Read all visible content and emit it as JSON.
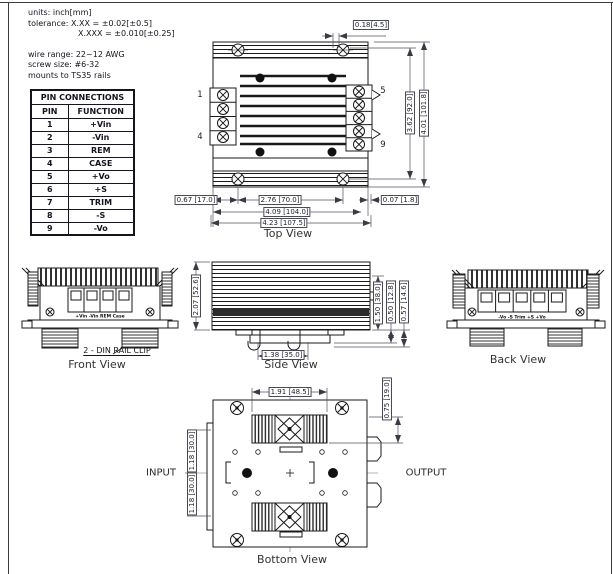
{
  "notes": {
    "units": "units: inch[mm]",
    "tol1": "tolerance: X.XX = ±0.02[±0.5]",
    "tol2": "X.XXX = ±0.010[±0.25]",
    "wire": "wire range: 22~12 AWG",
    "screw": "screw size: #6-32",
    "mount": "mounts to TS35 rails"
  },
  "pin_table": {
    "title": "PIN CONNECTIONS",
    "headers": {
      "pin": "PIN",
      "function": "FUNCTION"
    },
    "rows": [
      {
        "pin": "1",
        "fn": "+Vin"
      },
      {
        "pin": "2",
        "fn": "-Vin"
      },
      {
        "pin": "3",
        "fn": "REM"
      },
      {
        "pin": "4",
        "fn": "CASE"
      },
      {
        "pin": "5",
        "fn": "+Vo"
      },
      {
        "pin": "6",
        "fn": "+S"
      },
      {
        "pin": "7",
        "fn": "TRIM"
      },
      {
        "pin": "8",
        "fn": "-S"
      },
      {
        "pin": "9",
        "fn": "-Vo"
      }
    ]
  },
  "top_view": {
    "caption": "Top View",
    "pins": {
      "p1": "1",
      "p4": "4",
      "p5": "5",
      "p9": "9"
    },
    "dims": {
      "screw_offset": "0.18[4.5]",
      "body_height": "3.62 [92.0]",
      "total_height": "4.01 [101.8]",
      "left_offset": "0.67 [17.0]",
      "screw_span": "2.76 [70.0]",
      "right_offset": "0.07 [1.8]",
      "body_width": "4.09 [104.0]",
      "total_width": "4.23 [107.5]"
    }
  },
  "front_view": {
    "caption": "Front View",
    "terminals": "+Vin -Vin REM Case",
    "clip_note": "2 - DIN RAIL CLIP"
  },
  "side_view": {
    "caption": "Side View",
    "dims": {
      "height": "2.07 [52.6]",
      "fin_height": "1.50 [38.0]",
      "rail_offset": "0.50 [12.8]",
      "clip_offset": "0.57 [14.6]",
      "rail_width": "1.38 [35.0]"
    }
  },
  "back_view": {
    "caption": "Back View",
    "terminals": "-Vo -S Trim +S +Vo"
  },
  "bottom_view": {
    "caption": "Bottom View",
    "input": "INPUT",
    "output": "OUTPUT",
    "dims": {
      "fan_span": "1.91 [48.5]",
      "top_offset": "0.75 [19.0]",
      "upper_half": "1.18 [30.0]",
      "lower_half": "1.18 [30.0]"
    }
  }
}
